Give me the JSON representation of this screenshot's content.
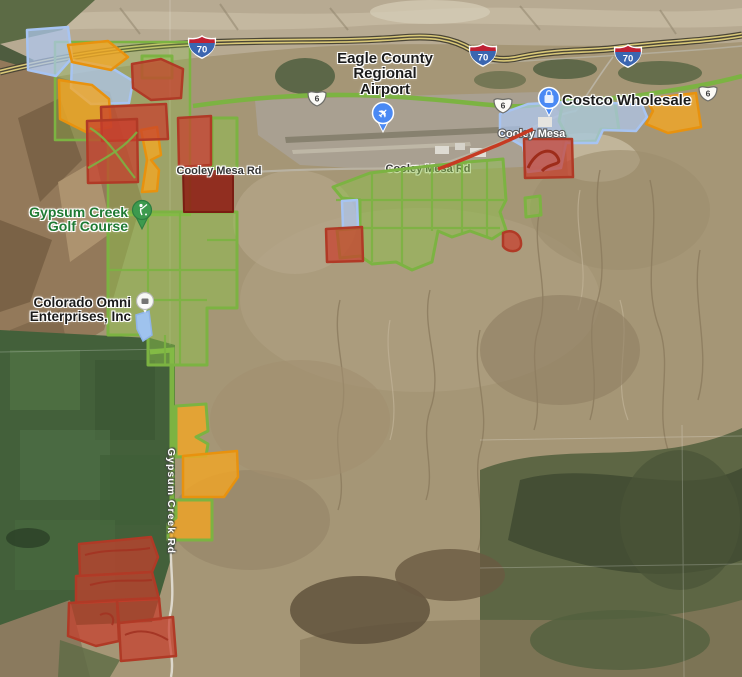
{
  "pois": {
    "airport": {
      "name": "Eagle County Regional Airport",
      "lines": [
        "Eagle County",
        "Regional",
        "Airport"
      ],
      "pin_glyph": "✈"
    },
    "costco": {
      "name": "Costco Wholesale"
    },
    "golf": {
      "name": "Gypsum Creek Golf Course",
      "lines": [
        "Gypsum Creek",
        "Golf Course"
      ]
    },
    "omni": {
      "name": "Colorado Omni Enterprises, Inc",
      "lines": [
        "Colorado Omni",
        "Enterprises, Inc"
      ]
    }
  },
  "roads": {
    "cooley_mesa_rd_left": "Cooley Mesa Rd",
    "cooley_mesa_rd_center": "Cooley Mesa Rd",
    "cooley_mesa_white": "Cooley Mesa",
    "gypsum_creek_rd": "Gypsum Creek Rd",
    "interstate_shield": "70",
    "us_route_shield": "6"
  },
  "colors": {
    "green-stroke": "#7CB342",
    "orange-stroke": "#E8920E",
    "red-stroke": "#B03A26",
    "blue-stroke": "#A7C4F2",
    "pin-blue": "#4A89F4",
    "pin-green": "#3D9A4E",
    "label-green": "#1F7A33",
    "road-red": "#C63A22",
    "hwy-yellow": "#D9C878"
  }
}
